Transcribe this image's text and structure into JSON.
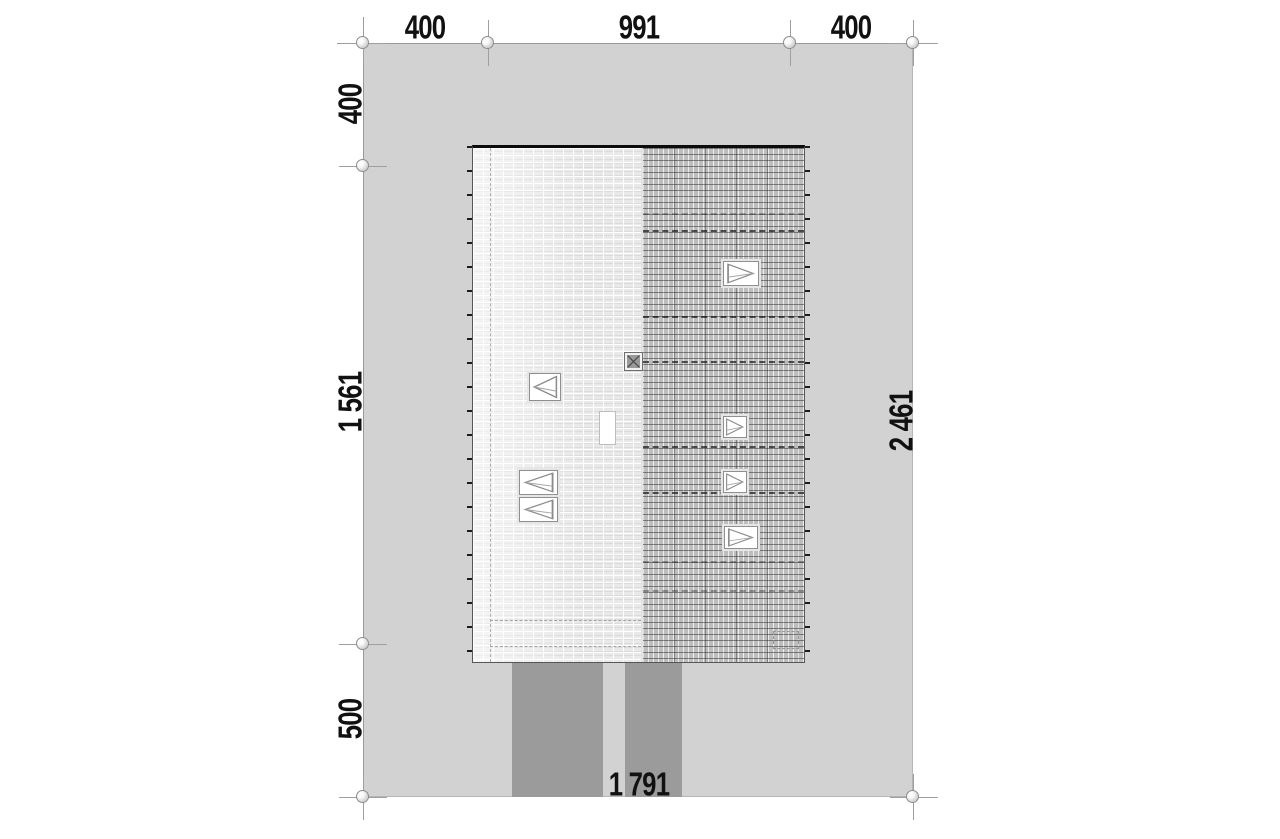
{
  "drawing": {
    "type": "architectural-site-plan-roof-view",
    "dimensions": {
      "top_left": "400",
      "top_center": "991",
      "top_right": "400",
      "left_top": "400",
      "left_middle": "1 561",
      "left_bottom": "500",
      "right_total": "2 461",
      "bottom_total": "1 791"
    },
    "dimension_values_cm": {
      "top": [
        400,
        991,
        400
      ],
      "left": [
        400,
        1561,
        500
      ],
      "right_total": 2461,
      "bottom_total": 1791
    },
    "colors": {
      "site_fill": "#d2d2d2",
      "driveway_fill": "#9b9b9b",
      "roof_left_fill": "#e9e9e9",
      "roof_right_fill": "#bdbdbd",
      "dimension_line": "#9a9a9a",
      "text": "#111111"
    },
    "roof": {
      "skylights_left_plane": 3,
      "skylights_right_plane": 4,
      "has_chimney_vent": true,
      "has_blank_roof_window": true
    }
  }
}
